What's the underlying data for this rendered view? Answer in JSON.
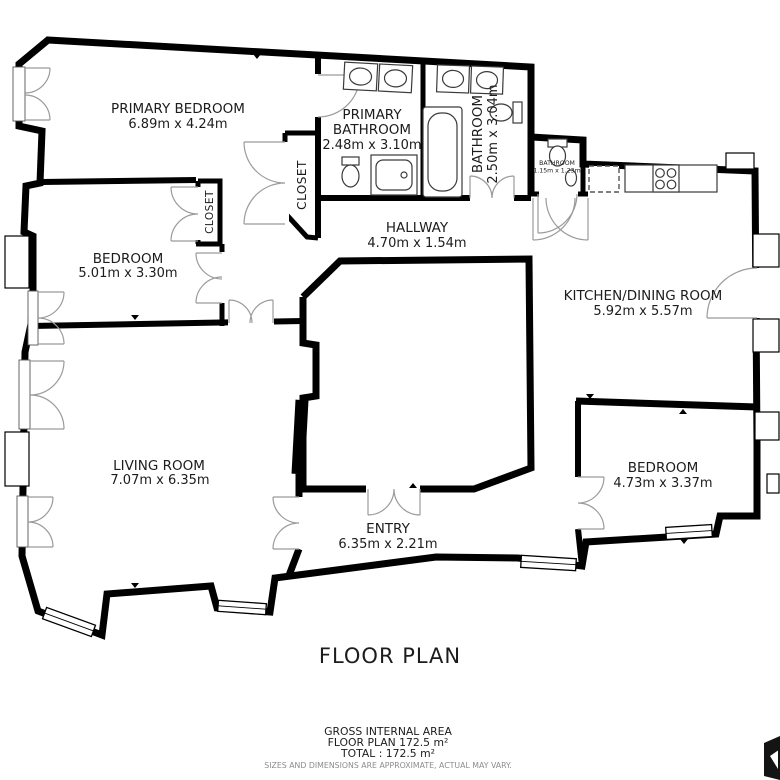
{
  "title": "FLOOR PLAN",
  "area_summary": {
    "line1": "GROSS INTERNAL AREA",
    "line2": "FLOOR PLAN 172.5 m²",
    "line3": "TOTAL :  172.5 m²",
    "disclaimer": "SIZES AND DIMENSIONS ARE APPROXIMATE, ACTUAL MAY VARY."
  },
  "rooms": {
    "primary_bedroom": {
      "name": "PRIMARY BEDROOM",
      "dims": "6.89m x 4.24m"
    },
    "primary_bathroom": {
      "name_line1": "PRIMARY",
      "name_line2": "BATHROOM",
      "dims": "2.48m x 3.10m"
    },
    "bathroom": {
      "name": "BATHROOM",
      "dims": "2.50m x 3.04m"
    },
    "small_bathroom": {
      "name": "BATHROOM",
      "dims": "1.15m x 1.23m"
    },
    "closet_left": {
      "name": "CLOSET"
    },
    "closet_right": {
      "name": "CLOSET"
    },
    "hallway": {
      "name": "HALLWAY",
      "dims": "4.70m x 1.54m"
    },
    "bedroom_left": {
      "name": "BEDROOM",
      "dims": "5.01m x 3.30m"
    },
    "kitchen_dining": {
      "name": "KITCHEN/DINING ROOM",
      "dims": "5.92m x 5.57m"
    },
    "living_room": {
      "name": "LIVING ROOM",
      "dims": "7.07m x 6.35m"
    },
    "entry": {
      "name": "ENTRY",
      "dims": "6.35m x 2.21m"
    },
    "bedroom_right": {
      "name": "BEDROOM",
      "dims": "4.73m x 3.37m"
    }
  },
  "icons": [
    "sink-icon",
    "toilet-icon",
    "bathtub-icon",
    "shower-icon",
    "stove-icon",
    "refrigerator-dashed-icon",
    "door-arc-icon",
    "window-icon",
    "logo-mark"
  ],
  "colors": {
    "wall": "#000000",
    "door_arc": "#9b9b9b",
    "fixture": "#3a3a3a",
    "text": "#1c1c1c",
    "muted_text": "#8c8c8c",
    "background": "#ffffff"
  }
}
